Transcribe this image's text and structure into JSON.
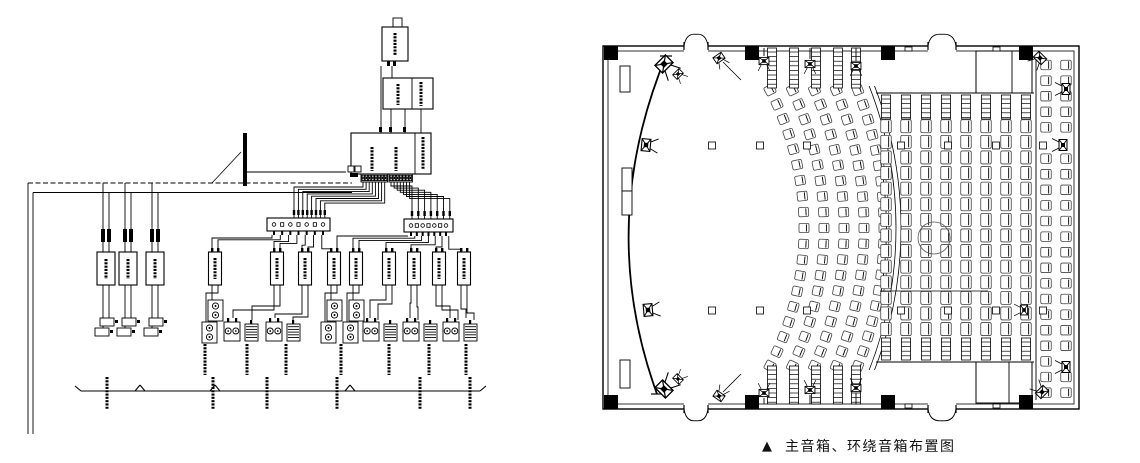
{
  "caption": {
    "marker": "▲",
    "text": "主音箱、环绕音箱布置图"
  },
  "schematic": {
    "stroke": "#000000",
    "bus": {
      "x1": 28,
      "x2": 352,
      "yDashed": 183,
      "ySolid": 192.5,
      "dropXs": [
        28,
        33
      ],
      "dropY": 434
    },
    "cable_marker": {
      "x": 245,
      "y1": 133,
      "y2": 186,
      "leader": [
        212,
        183,
        241,
        152
      ]
    },
    "source_chain": {
      "antenna": [
        393,
        18,
        9,
        9
      ],
      "boxA": [
        382,
        27,
        26,
        34
      ],
      "boxB": [
        383,
        78,
        50,
        31
      ],
      "boxB_divider": 412,
      "boxC": [
        351,
        133,
        80,
        41
      ],
      "boxC_divider": 415,
      "wires": [
        [
          381,
          66,
          381,
          133
        ],
        [
          392,
          66,
          392,
          78
        ],
        [
          391,
          109,
          391,
          133
        ],
        [
          405,
          109,
          405,
          133
        ],
        [
          421,
          109,
          421,
          133
        ]
      ],
      "ticks": [
        [
          387,
          61
        ],
        [
          393,
          61
        ],
        [
          379,
          127
        ],
        [
          389,
          127
        ],
        [
          403,
          127
        ]
      ],
      "connector": [
        348,
        166
      ],
      "conn_wire": [
        346,
        172,
        245,
        172
      ]
    },
    "strips": [
      {
        "x": 361,
        "y": 174,
        "cells": 8
      },
      {
        "x": 389,
        "y": 174,
        "cells": 7
      }
    ],
    "dist_boxes": [
      {
        "x": 267,
        "y": 218,
        "w": 63,
        "h": 13,
        "glyphs": 7
      },
      {
        "x": 404,
        "y": 219,
        "w": 49,
        "h": 13,
        "glyphs": 7
      }
    ],
    "fan_left": {
      "lx0": 294,
      "lstep": 4.4
    },
    "fan_right": {
      "rx0": 412,
      "rstep": 6.3
    },
    "left_chains": {
      "pairs": [
        [
          103,
          109
        ],
        [
          125,
          131
        ],
        [
          152,
          158
        ]
      ],
      "connY": 229,
      "ampY": 252,
      "ampH": 33,
      "spkY": 318
    },
    "amps": {
      "y": 252,
      "w": 13,
      "h": 33,
      "xs": [
        215,
        277,
        305,
        334,
        356,
        389,
        414,
        439,
        464
      ]
    },
    "left_dist_targets": [
      212,
      218,
      274,
      280,
      302,
      308,
      331
    ],
    "right_dist_targets": [
      337,
      353,
      359,
      386,
      411,
      436,
      461
    ],
    "column_speaker_xs": [
      215,
      334,
      356
    ],
    "pair_xs": [
      242,
      284,
      381,
      421,
      461
    ],
    "pair_wire_xs": [
      370,
      378,
      410,
      418,
      450,
      458,
      466,
      474
    ],
    "labels_row": {
      "y1": 344,
      "y2": 375,
      "xs": [
        205,
        247,
        286,
        341,
        389,
        429,
        466
      ]
    },
    "group_line": {
      "y": 391,
      "x1": 75,
      "x2": 480,
      "ticks": [
        75,
        140,
        215,
        350,
        480
      ],
      "labels": {
        "xs": [
          107,
          213,
          267,
          337,
          420,
          470
        ],
        "y1": 377,
        "y2": 409
      }
    }
  },
  "floorplan": {
    "outer": [
      603,
      46,
      476,
      363
    ],
    "inner_offset": 5,
    "columns": {
      "size": 14,
      "xs": [
        611,
        752,
        888,
        1026
      ],
      "topY": 53,
      "bottomY": 402
    },
    "doors": {
      "top": [
        [
          684,
          708
        ],
        [
          928,
          956
        ]
      ],
      "bottom": [
        [
          684,
          708
        ],
        [
          928,
          956
        ]
      ]
    },
    "booths": [
      {
        "x": 976,
        "y": 51,
        "w": 56,
        "h": 42,
        "div": 1012
      },
      {
        "x": 976,
        "y": 362,
        "w": 56,
        "h": 41,
        "div": 1009
      }
    ],
    "screen": {
      "p0": [
        666,
        56
      ],
      "c": [
        596,
        226
      ],
      "p1": [
        657,
        394
      ]
    },
    "wall_panels": [
      [
        620,
        66,
        10,
        26
      ],
      [
        622,
        168,
        10,
        23
      ],
      [
        622,
        191,
        10,
        24
      ],
      [
        620,
        360,
        10,
        28
      ]
    ],
    "curved": {
      "cx": 507,
      "cy": 228,
      "radii": [
        297,
        317,
        337,
        357,
        377
      ],
      "seats": 19,
      "halfChord": 138,
      "boundary": [
        389,
        394
      ],
      "stair_xs": [
        772,
        794,
        816,
        838,
        856
      ],
      "stairs_top": [
        48,
        88
      ],
      "stairs_bottom": [
        366,
        404
      ]
    },
    "straight": {
      "col_xs": [
        886,
        906,
        926,
        946,
        966,
        986,
        1006,
        1026
      ],
      "seatW": 13,
      "seatH": 10.5,
      "row_y0": 121,
      "rows": 14,
      "pitch": 15.6,
      "stairs_top": [
        95,
        119
      ],
      "stairs_bottom": [
        338,
        360
      ],
      "rail_top": 93,
      "rail_bottom": 362,
      "aisle_line": [
        880,
        291,
        988,
        291
      ],
      "circle": [
        934,
        238,
        16
      ]
    },
    "wall_cols": {
      "xs": [
        1046,
        1066
      ],
      "y0": 60,
      "rows": 22,
      "pitch": 15.6,
      "gap1": [
        136,
        154
      ],
      "gap2": [
        356,
        376
      ]
    },
    "aisle_rail": {
      "x": 1036,
      "y1": 60,
      "y2": 400
    },
    "floor_squares": {
      "size": 7,
      "xs": [
        712,
        760,
        807,
        901,
        948,
        996,
        1043
      ],
      "rows_y": [
        142,
        307
      ]
    },
    "wall_marks": [
      [
        905,
        47
      ],
      [
        993,
        47
      ],
      [
        905,
        404
      ],
      [
        993,
        404
      ]
    ],
    "speakers": [
      {
        "x": 664,
        "y": 64,
        "rot": -45,
        "s": 1.35
      },
      {
        "x": 678,
        "y": 74,
        "rot": -45,
        "s": 0.8
      },
      {
        "x": 719,
        "y": 58,
        "rot": -35,
        "s": 0.9,
        "lead": [
          723,
          62,
          741,
          80
        ]
      },
      {
        "x": 764,
        "y": 61,
        "rot": 0,
        "s": 0.9,
        "drop": [
          764,
          48,
          764,
          56
        ]
      },
      {
        "x": 810,
        "y": 64,
        "rot": 0,
        "s": 0.9,
        "drop": [
          810,
          48,
          810,
          59
        ]
      },
      {
        "x": 856,
        "y": 66,
        "rot": 0,
        "s": 0.9,
        "drop": [
          856,
          48,
          856,
          61
        ]
      },
      {
        "x": 646,
        "y": 145,
        "rot": -85,
        "s": 1.1
      },
      {
        "x": 648,
        "y": 310,
        "rot": -95,
        "s": 1.1
      },
      {
        "x": 664,
        "y": 389,
        "rot": -135,
        "s": 1.35
      },
      {
        "x": 678,
        "y": 379,
        "rot": -135,
        "s": 0.8
      },
      {
        "x": 719,
        "y": 396,
        "rot": -145,
        "s": 0.9,
        "lead": [
          723,
          392,
          741,
          374
        ]
      },
      {
        "x": 764,
        "y": 393,
        "rot": 180,
        "s": 0.9,
        "drop": [
          764,
          398,
          764,
          404
        ]
      },
      {
        "x": 810,
        "y": 390,
        "rot": 180,
        "s": 0.9,
        "drop": [
          810,
          395,
          810,
          404
        ]
      },
      {
        "x": 856,
        "y": 388,
        "rot": 180,
        "s": 0.9,
        "drop": [
          856,
          393,
          856,
          404
        ]
      },
      {
        "x": 1040,
        "y": 58,
        "rot": 45,
        "s": 1.0
      },
      {
        "x": 1066,
        "y": 89,
        "rot": 90,
        "s": 1.0
      },
      {
        "x": 1063,
        "y": 145,
        "rot": 90,
        "s": 1.0
      },
      {
        "x": 1024,
        "y": 310,
        "rot": 90,
        "s": 0.9
      },
      {
        "x": 1066,
        "y": 367,
        "rot": 90,
        "s": 1.0
      },
      {
        "x": 1042,
        "y": 392,
        "rot": 135,
        "s": 1.0
      }
    ]
  }
}
